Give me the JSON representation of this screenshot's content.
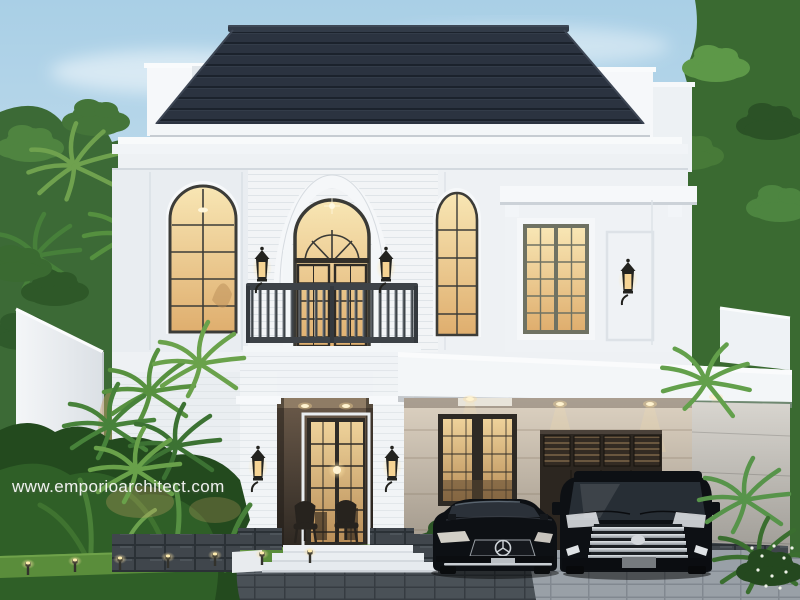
{
  "watermark": {
    "text": "www.emporioarchitect.com"
  },
  "colors": {
    "sky_top": "#a9cfe6",
    "sky_bottom": "#e4eff5",
    "roof": "#2b3340",
    "wall": "#eef1f4",
    "trim": "#f3f6f8",
    "glass_warm": "#f8e6b4",
    "glass_deep": "#dfae6e",
    "railing": "#3d4247",
    "stone": "#40464c",
    "lawn": "#5a8d3b",
    "foliage": "#3c6a36",
    "driveway": "#99a0a7",
    "car_body": "#0d1014",
    "chrome": "#cdd2d7",
    "warm_light": "#ffe6a8"
  }
}
